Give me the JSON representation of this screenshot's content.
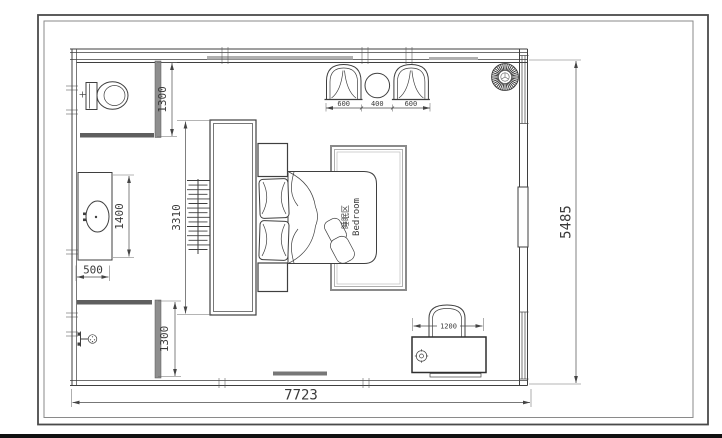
{
  "sheet": {
    "type": "bedroom plan drawing",
    "colors": {
      "line": "#3f3f3f",
      "border_outer": "#4a4a4a",
      "border_inner": "#8a8a8a",
      "wall_fill": "#8e8e8e",
      "door_strip": "#5f5f5f",
      "rug_line": "#8a8a8a",
      "background": "#ffffff",
      "bottom_edge": "#101010"
    }
  },
  "plan": {
    "labels": {
      "sleep_zone_cn": "睡眠区",
      "sleep_zone_en": "Bedroom"
    },
    "dimensions": {
      "toilet_room": "1300",
      "vanity_length": "1400",
      "vanity_width": "500",
      "wardrobe": "3310",
      "shower_room": "1300",
      "armchair_left": "600",
      "side_table": "400",
      "armchair_right": "600",
      "desk_chair": "1200",
      "room_depth": "5485",
      "room_width": "7723"
    }
  }
}
